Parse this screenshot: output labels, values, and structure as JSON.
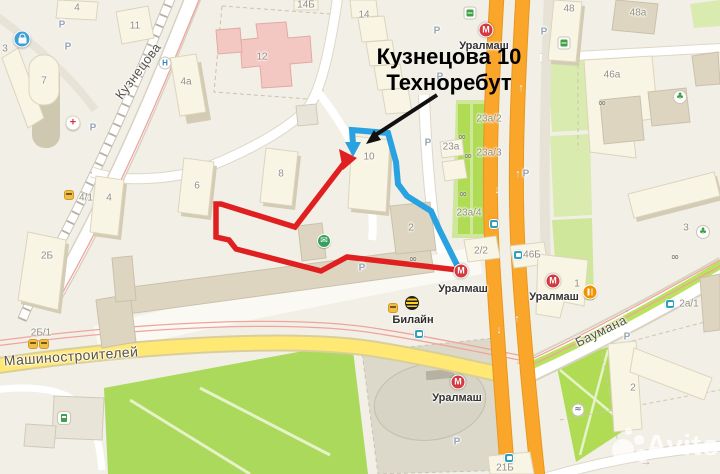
{
  "annotation": {
    "line1": "Кузнецова 10",
    "line2": "Техноребут"
  },
  "watermark": {
    "text": "Avito"
  },
  "streets": {
    "kuznetsova": "Кузнецова",
    "mashinostroiteley": "Машиностроителей",
    "baumana": "Баумана"
  },
  "metro": {
    "symbol": "М",
    "name": "Уралмаш"
  },
  "poi": {
    "beeline": "Билайн"
  },
  "parking_label": "Р",
  "icons": {
    "postal": "✉",
    "pharmacy": "+",
    "medical": "Н",
    "shop": "♣",
    "fountain": "≈",
    "bike": "∞",
    "arrow_up": "↑",
    "arrow_down": "↓",
    "arrow_left": "←",
    "arrow_right": "→"
  },
  "buildings": {
    "b3": "3",
    "b7": "7",
    "b4": "4",
    "b11": "11",
    "b4a": "4а",
    "b14b": "14Б",
    "b14": "14",
    "b12": "12",
    "b10": "10",
    "b8": "8",
    "b6": "6",
    "b4m": "4",
    "b4_1": "4/1",
    "b2b": "2Б",
    "b2b1": "2Б/1",
    "b2_2": "2/2",
    "b2": "2",
    "b46b": "46Б",
    "b1": "1",
    "b48": "48",
    "b48a": "48а",
    "b46a": "46а",
    "b23a2": "23а/2",
    "b23a": "23а",
    "b23a3": "23а/3",
    "b23a4": "23а/4",
    "b2r": "2",
    "b2a1": "2а/1",
    "b3r": "3",
    "b21b": "21Б"
  },
  "colors": {
    "route_red": "#e02020",
    "route_blue": "#28a2e0",
    "annotation_black": "#000000",
    "road_orange": "#f9a62b",
    "road_yellow": "#ffe873",
    "park_green": "#abd95c",
    "metro_red": "#d4393f",
    "beeline_yellow": "#ffd21e"
  }
}
